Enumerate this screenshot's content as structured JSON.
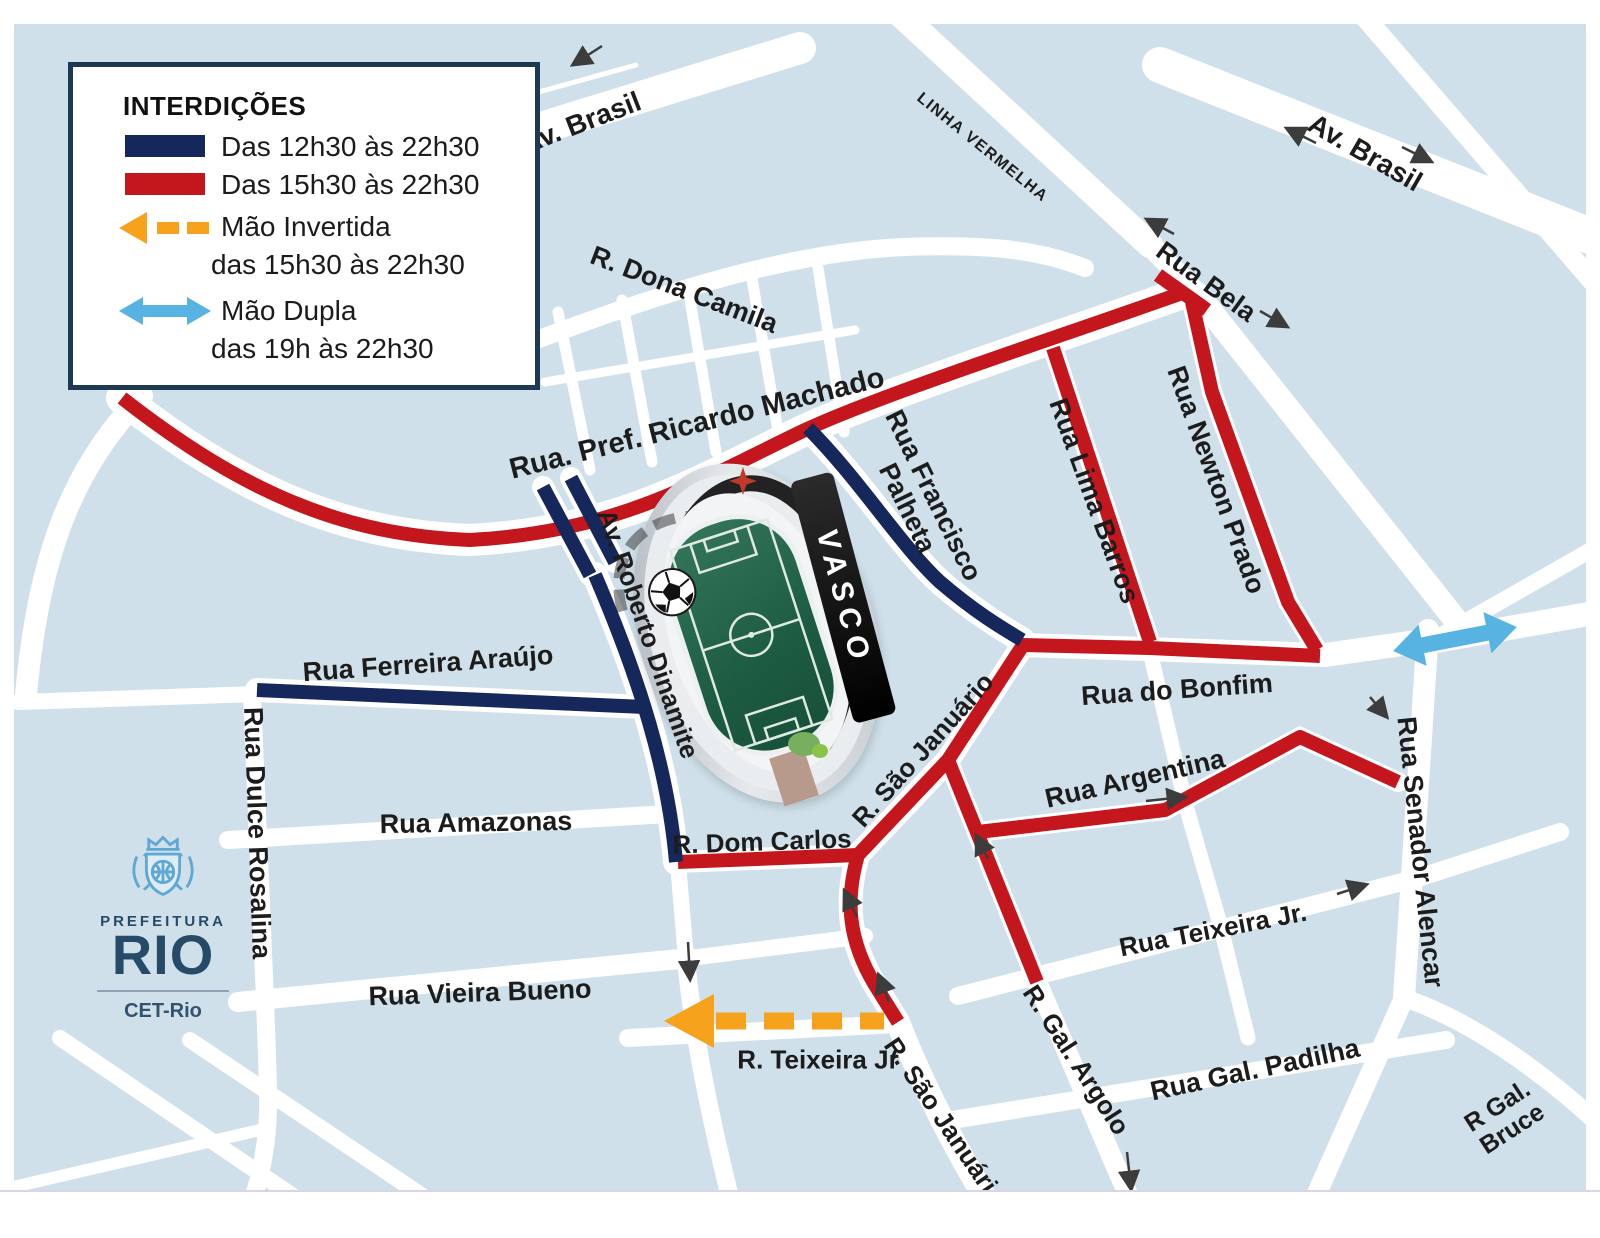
{
  "colors": {
    "map_bg": "#cfe0ea",
    "closure_12h30": "#16275c",
    "closure_15h30": "#c4161d",
    "inverted_flow": "#f6a21d",
    "two_way": "#56b3e2"
  },
  "legend": {
    "title": "INTERDIÇÕES",
    "item1": "Das 12h30 às 22h30",
    "item2": "Das 15h30 às 22h30",
    "item3_line1": "Mão Invertida",
    "item3_line2": "das 15h30 às 22h30",
    "item4_line1": "Mão Dupla",
    "item4_line2": "das 19h às 22h30"
  },
  "logo": {
    "prefeitura": "PREFEITURA",
    "rio": "RIO",
    "agency": "CET-Rio"
  },
  "stadium": {
    "club": "VASCO"
  },
  "streets": {
    "av_brasil_w": "Av. Brasil",
    "av_brasil_e": "Av. Brasil",
    "linha_vermelha": "LINHA VERMELHA",
    "rua_bela": "Rua Bela",
    "dona_camila": "R. Dona Camila",
    "ricardo_machado": "Rua. Pref. Ricardo Machado",
    "francisco_palheta_1": "Rua Francisco",
    "francisco_palheta_2": "Palheta",
    "lima_barros": "Rua Lima Barros",
    "newton_prado": "Rua Newton Prado",
    "roberto_dinamite": "Av. Roberto Dinamite",
    "ferreira_araujo": "Rua Ferreira Araújo",
    "dulce_rosalina": "Rua Dulce Rosalina",
    "amazonas": "Rua Amazonas",
    "dom_carlos": "R. Dom Carlos",
    "sao_januario_n": "R.  São Januário",
    "bonfim": "Rua do Bonfim",
    "argentina": "Rua Argentina",
    "senador_alencar": "Rua Senador Alencar",
    "teixeira_jr_e": "Rua Teixeira Jr.",
    "gal_argolo": "R. Gal. Argolo",
    "gal_padilha": "Rua Gal. Padilha",
    "gal_bruce_1": "R Gal.",
    "gal_bruce_2": "Bruce",
    "vieira_bueno": "Rua Vieira Bueno",
    "teixeira_jr_s": "R.  Teixeira Jr",
    "sao_januario_s": "R.  São Januário"
  }
}
